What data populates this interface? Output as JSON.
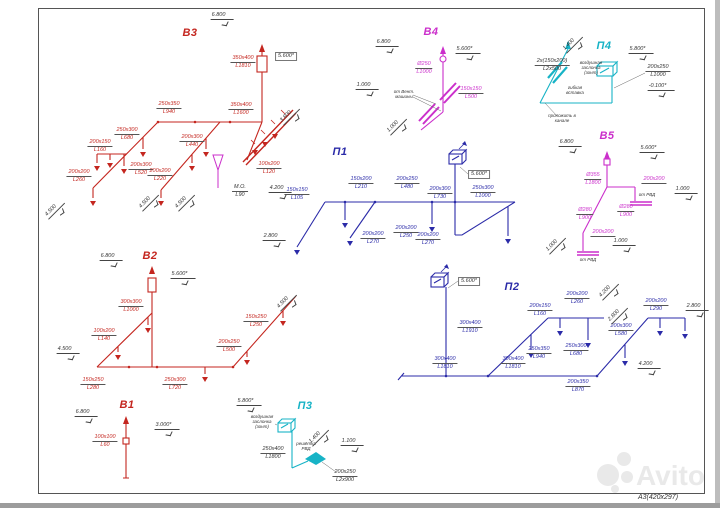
{
  "sheet": {
    "format": "А3(420х297)",
    "watermark": "Avito"
  },
  "colors": {
    "exhaust_red": "#c4261f",
    "exhaust_magenta": "#cb2fcb",
    "supply_blue": "#2b2ba8",
    "supply_cyan": "#17b3c6",
    "dims": "#333333"
  },
  "b3": {
    "title": "В3",
    "riser": {
      "size": "350x400",
      "len": "L1810"
    },
    "main_l": {
      "size": "250x350",
      "len": "L940"
    },
    "main_r": {
      "size": "350x400",
      "len": "L1600"
    },
    "br680": {
      "size": "250x300",
      "len": "L680"
    },
    "br160": {
      "size": "200x150",
      "len": "L160"
    },
    "br520": {
      "size": "200x300",
      "len": "L520"
    },
    "br440": {
      "size": "200x300",
      "len": "L440"
    },
    "br220": {
      "size": "200x200",
      "len": "L220"
    },
    "br260": {
      "size": "200x200",
      "len": "L260"
    },
    "br120": {
      "size": "100x200",
      "len": "L120"
    },
    "mo": {
      "size": "М.О.",
      "len": "L90"
    },
    "e68": "6.800",
    "e56": "5.600*",
    "e38": "3.800",
    "e45a": "4.500",
    "e45b": "4.500",
    "e45c": "4.500",
    "e42": "4.200"
  },
  "b4": {
    "title": "В4",
    "riser": {
      "size": "Ø250",
      "len": "L1000"
    },
    "gr": {
      "size": "150x150",
      "len": "L500"
    },
    "note": "от Вент.\nмашины",
    "e68": "6.800",
    "e56": "5.600*",
    "e10": "1.000",
    "e10b": "1.000"
  },
  "p4": {
    "title": "П4",
    "duct1": {
      "size": "2х(150х200)",
      "len": "L2х500"
    },
    "duct2": {
      "size": "200x250",
      "len": "L1000"
    },
    "note1": "воздушная\nзаслонка\n(зонт)",
    "note2": "гибкая\nвставка",
    "note3": "проложить в\nканале",
    "e14": "1.400",
    "e58": "5.800*",
    "e01": "-0.100*"
  },
  "b5": {
    "title": "В5",
    "riser": {
      "size": "Ø355",
      "len": "L1800"
    },
    "d1": {
      "size": "Ø280",
      "len": "L900"
    },
    "d2": {
      "size": "Ø280",
      "len": "L900"
    },
    "gr1": {
      "size": "200x200",
      "len": ""
    },
    "gr2": {
      "size": "200x200",
      "len": ""
    },
    "note1": "от РВД",
    "note2": "от РВД",
    "e68": "6.800",
    "e56": "5.600*",
    "e10a": "1.000",
    "e10b": "1.000",
    "e10c": "1.000"
  },
  "p1": {
    "title": "П1",
    "riser": {
      "size": "250x300",
      "len": "L1000"
    },
    "s105": {
      "size": "150x150",
      "len": "L105"
    },
    "s210": {
      "size": "150x200",
      "len": "L210"
    },
    "s480": {
      "size": "200x250",
      "len": "L480"
    },
    "s730": {
      "size": "200x300",
      "len": "L730"
    },
    "s270a": {
      "size": "200x200",
      "len": "L270"
    },
    "s250": {
      "size": "200x200",
      "len": "L250"
    },
    "s270b": {
      "size": "200x200",
      "len": "L270"
    },
    "e56": "5.600*",
    "e28": "2.800"
  },
  "p2": {
    "title": "П2",
    "riser": {
      "size": "300x400",
      "len": "L1910"
    },
    "s1810a": {
      "size": "300x400",
      "len": "L1810"
    },
    "s1810b": {
      "size": "300x400",
      "len": "L1810"
    },
    "s870": {
      "size": "200x350",
      "len": "L870"
    },
    "s940": {
      "size": "250x350",
      "len": "L940"
    },
    "s680": {
      "size": "250x300",
      "len": "L680"
    },
    "s160": {
      "size": "200x150",
      "len": "L160"
    },
    "s260": {
      "size": "200x200",
      "len": "L260"
    },
    "s580": {
      "size": "200x300",
      "len": "L580"
    },
    "s290": {
      "size": "200x200",
      "len": "L290"
    },
    "e56": "5.600*",
    "e42a": "4.200",
    "e28a": "2.800",
    "e28b": "2.800",
    "e42b": "4.200"
  },
  "b2": {
    "title": "В2",
    "riser": {
      "size": "300x300",
      "len": "L1000"
    },
    "s140": {
      "size": "100x200",
      "len": "L140"
    },
    "s280": {
      "size": "150x250",
      "len": "L280"
    },
    "s720": {
      "size": "250x300",
      "len": "L720"
    },
    "s500": {
      "size": "200x250",
      "len": "L500"
    },
    "s250": {
      "size": "150x250",
      "len": "L250"
    },
    "e68": "6.800",
    "e56": "5.600*",
    "e45a": "4.500",
    "e45b": "4.500"
  },
  "b1": {
    "title": "В1",
    "riser": {
      "size": "100x100",
      "len": "L60"
    },
    "e68": "6.800",
    "e30": "3.000*"
  },
  "p3": {
    "title": "П3",
    "duct1": {
      "size": "250x400",
      "len": "L1800"
    },
    "duct2": {
      "size": "200x250",
      "len": "L2x900"
    },
    "note1": "воздушная\nзаслонка\n(зонт)",
    "note2": "решётка\nРВД",
    "e58": "5.800*",
    "e14": "1.400",
    "e11": "1.100"
  }
}
